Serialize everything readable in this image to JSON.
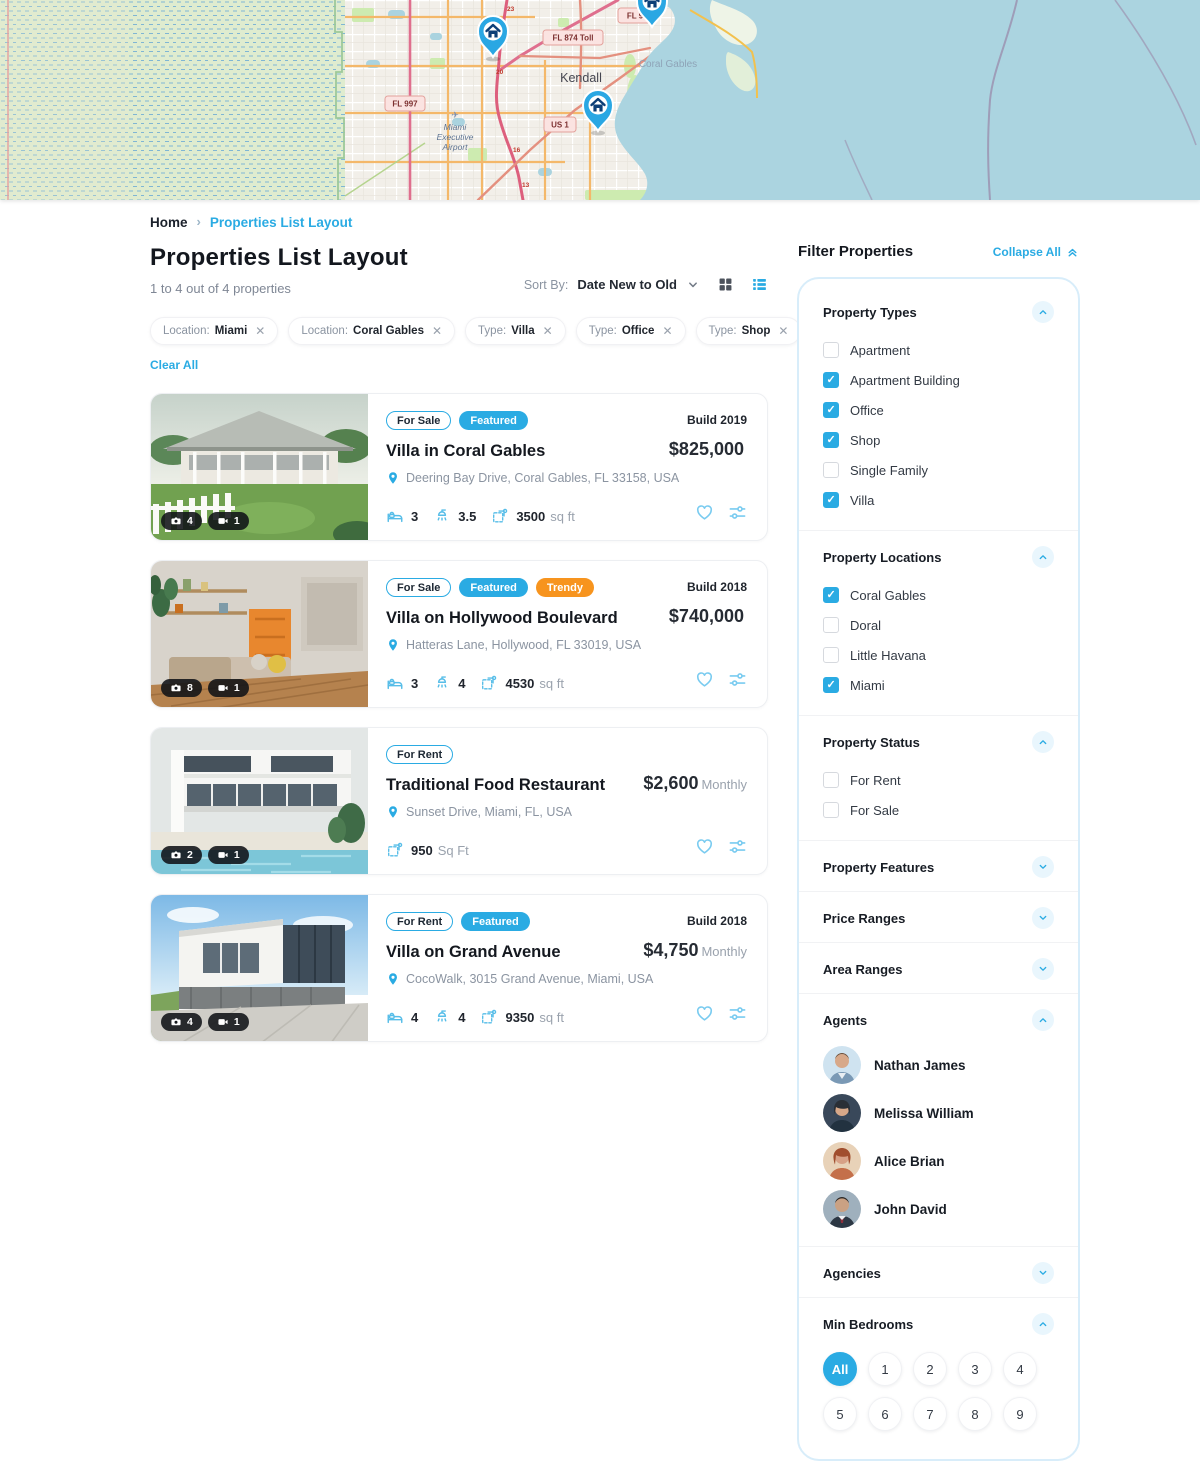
{
  "colors": {
    "accent": "#2aabe3",
    "orange": "#f7941e",
    "water": "#abd4e0"
  },
  "map": {
    "kendall": "Kendall",
    "coral_gables": "Coral Gables",
    "airport_line1": "Miami",
    "airport_line2": "Executive",
    "airport_line3": "Airport",
    "badge_874": "FL 874 Toll",
    "badge_997": "FL 997",
    "badge_us1": "US 1",
    "badge_fl9": "FL 9",
    "exits": [
      "23",
      "20",
      "16",
      "13"
    ]
  },
  "breadcrumb": {
    "home": "Home",
    "current": "Properties List Layout"
  },
  "header": {
    "title": "Properties List Layout",
    "count_text": "1 to 4 out of 4 properties",
    "sort_by_label": "Sort By:",
    "sort_value": "Date New to Old"
  },
  "filters_bar": {
    "chips": [
      {
        "prefix": "Location:",
        "value": "Miami"
      },
      {
        "prefix": "Location:",
        "value": "Coral Gables"
      },
      {
        "prefix": "Type:",
        "value": "Villa"
      },
      {
        "prefix": "Type:",
        "value": "Office"
      },
      {
        "prefix": "Type:",
        "value": "Shop"
      },
      {
        "prefix": "Type:",
        "value": "Apartment Building"
      }
    ],
    "clear_all": "Clear All"
  },
  "cards": [
    {
      "badges": [
        {
          "label": "For Sale"
        },
        {
          "label": "Featured"
        }
      ],
      "build": "Build 2019",
      "title": "Villa in Coral Gables",
      "price": "$825,000",
      "price_suffix": "",
      "address": "Deering Bay Drive, Coral Gables, FL 33158, USA",
      "photo_count": "4",
      "video_count": "1",
      "beds": "3",
      "baths": "3.5",
      "area": "3500",
      "area_unit": "sq ft"
    },
    {
      "badges": [
        {
          "label": "For Sale"
        },
        {
          "label": "Featured"
        },
        {
          "label": "Trendy"
        }
      ],
      "build": "Build 2018",
      "title": "Villa on Hollywood Boulevard",
      "price": "$740,000",
      "price_suffix": "",
      "address": "Hatteras Lane, Hollywood, FL 33019, USA",
      "photo_count": "8",
      "video_count": "1",
      "beds": "3",
      "baths": "4",
      "area": "4530",
      "area_unit": "sq ft"
    },
    {
      "badges": [
        {
          "label": "For Rent"
        }
      ],
      "build": "",
      "title": "Traditional Food Restaurant",
      "price": "$2,600",
      "price_suffix": "Monthly",
      "address": "Sunset Drive, Miami, FL, USA",
      "photo_count": "2",
      "video_count": "1",
      "area": "950",
      "area_unit": "Sq Ft"
    },
    {
      "badges": [
        {
          "label": "For Rent"
        },
        {
          "label": "Featured"
        }
      ],
      "build": "Build 2018",
      "title": "Villa on Grand Avenue",
      "price": "$4,750",
      "price_suffix": "Monthly",
      "address": "CocoWalk, 3015 Grand Avenue, Miami, USA",
      "photo_count": "4",
      "video_count": "1",
      "beds": "4",
      "baths": "4",
      "area": "9350",
      "area_unit": "sq ft"
    }
  ],
  "sidebar": {
    "title": "Filter Properties",
    "collapse_all": "Collapse All",
    "property_types": {
      "title": "Property Types",
      "items": [
        {
          "label": "Apartment",
          "checked": false
        },
        {
          "label": "Apartment Building",
          "checked": true
        },
        {
          "label": "Office",
          "checked": true
        },
        {
          "label": "Shop",
          "checked": true
        },
        {
          "label": "Single Family",
          "checked": false
        },
        {
          "label": "Villa",
          "checked": true
        }
      ]
    },
    "property_locations": {
      "title": "Property Locations",
      "items": [
        {
          "label": "Coral Gables",
          "checked": true
        },
        {
          "label": "Doral",
          "checked": false
        },
        {
          "label": "Little Havana",
          "checked": false
        },
        {
          "label": "Miami",
          "checked": true
        }
      ]
    },
    "property_status": {
      "title": "Property Status",
      "items": [
        {
          "label": "For Rent",
          "checked": false
        },
        {
          "label": "For Sale",
          "checked": false
        }
      ]
    },
    "property_features": {
      "title": "Property Features"
    },
    "price_ranges": {
      "title": "Price Ranges"
    },
    "area_ranges": {
      "title": "Area Ranges"
    },
    "agents": {
      "title": "Agents",
      "items": [
        {
          "name": "Nathan James"
        },
        {
          "name": "Melissa William"
        },
        {
          "name": "Alice Brian"
        },
        {
          "name": "John David"
        }
      ]
    },
    "agencies": {
      "title": "Agencies"
    },
    "min_bedrooms": {
      "title": "Min Bedrooms",
      "options": [
        "All",
        "1",
        "2",
        "3",
        "4",
        "5",
        "6",
        "7",
        "8",
        "9"
      ],
      "selected": "All"
    }
  }
}
